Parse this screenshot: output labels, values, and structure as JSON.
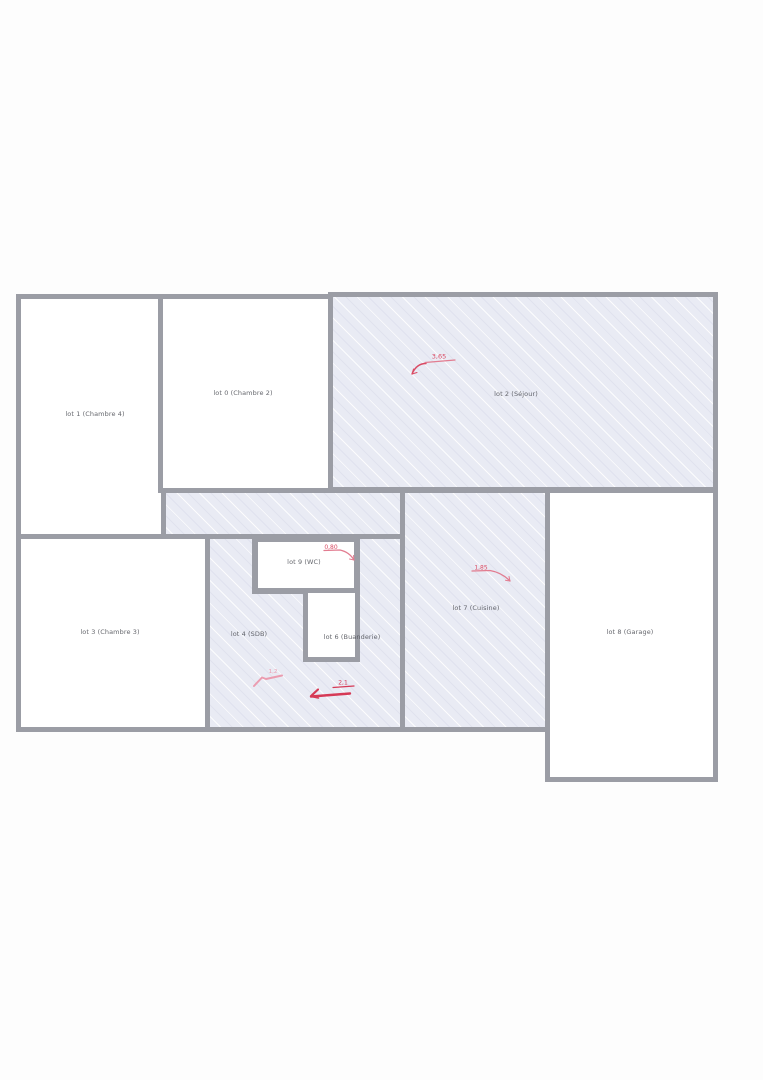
{
  "plan": {
    "name": "plan-des-lots",
    "wall_color": "#9b9da5",
    "hatch_fill": "#e9ebf4",
    "annotation_color": "#d94a63",
    "annotation_color_light": "#eb9cb0",
    "rooms": [
      {
        "name": "chambre-4",
        "label": "lot 1 (Chambre 4)",
        "fill": "white"
      },
      {
        "name": "chambre-2",
        "label": "lot 0 (Chambre 2)",
        "fill": "white"
      },
      {
        "name": "sejour",
        "label": "lot 2 (Séjour)",
        "fill": "hatched"
      },
      {
        "name": "degagement",
        "label": "",
        "fill": "hatched"
      },
      {
        "name": "chambre-3",
        "label": "lot 3 (Chambre 3)",
        "fill": "white"
      },
      {
        "name": "sdb",
        "label": "lot 4 (SDB)",
        "fill": "hatched"
      },
      {
        "name": "wc",
        "label": "lot 9 (WC)",
        "fill": "white"
      },
      {
        "name": "buanderie",
        "label": "lot 6 (Buanderie)",
        "fill": "white"
      },
      {
        "name": "cuisine",
        "label": "lot 7 (Cuisine)",
        "fill": "hatched"
      },
      {
        "name": "garage",
        "label": "lot 8 (Garage)",
        "fill": "white"
      }
    ],
    "annotations": [
      {
        "room": "sejour",
        "text": "3,65"
      },
      {
        "room": "wc",
        "text": "0,80"
      },
      {
        "room": "cuisine",
        "text": "1,85"
      },
      {
        "room": "sdb",
        "text": "1,2"
      },
      {
        "room": "buanderie",
        "text": "2,1"
      }
    ]
  }
}
